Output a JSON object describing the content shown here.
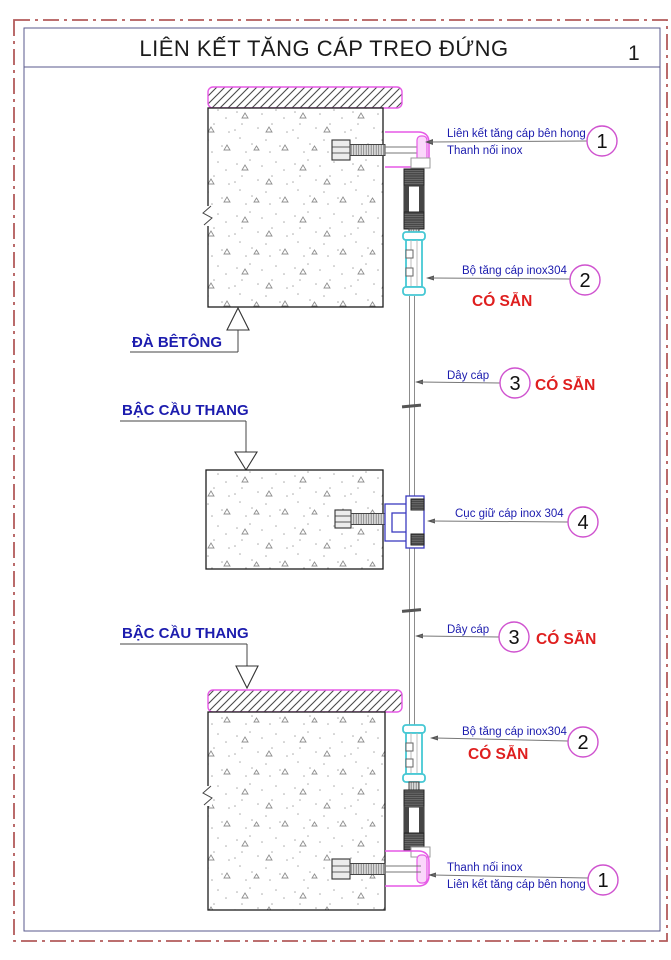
{
  "sheet": {
    "title": "LIÊN KẾT TĂNG CÁP TREO ĐỨNG",
    "number": "1"
  },
  "colors": {
    "label_blue": "#1c1cae",
    "note_red": "#df1f1f",
    "circle_magenta": "#cf52cf",
    "bracket_magenta": "#e659e6",
    "turnbuckle_cyan": "#46c8d4",
    "holder_blue": "#3b3bbf",
    "frame_red": "#b25b5b",
    "border_slate": "#5a5a8c"
  },
  "drawing": {
    "beam_label": "ĐÀ BÊTÔNG",
    "stair_label_upper": "BẬC CẦU THANG",
    "stair_label_lower": "BẬC CẦU THANG",
    "callouts": {
      "side_link_top": {
        "number": "1",
        "line1": "Liên kết tăng cáp bên hong",
        "line2": "Thanh nối inox"
      },
      "turnbuckle_top": {
        "number": "2",
        "label": "Bộ tăng cáp inox304",
        "note": "CÓ SẴN"
      },
      "cable_upper": {
        "number": "3",
        "label": "Dây cáp",
        "note": "CÓ SẴN"
      },
      "cable_holder": {
        "number": "4",
        "label": "Cục giữ cáp inox 304"
      },
      "cable_lower": {
        "number": "3",
        "label": "Dây cáp",
        "note": "CÓ SẴN"
      },
      "turnbuckle_bottom": {
        "number": "2",
        "label": "Bộ tăng cáp inox304",
        "note": "CÓ SẴN"
      },
      "side_link_bottom": {
        "number": "1",
        "line1": "Thanh nối inox",
        "line2": "Liên kết tăng cáp bên hong"
      }
    }
  }
}
